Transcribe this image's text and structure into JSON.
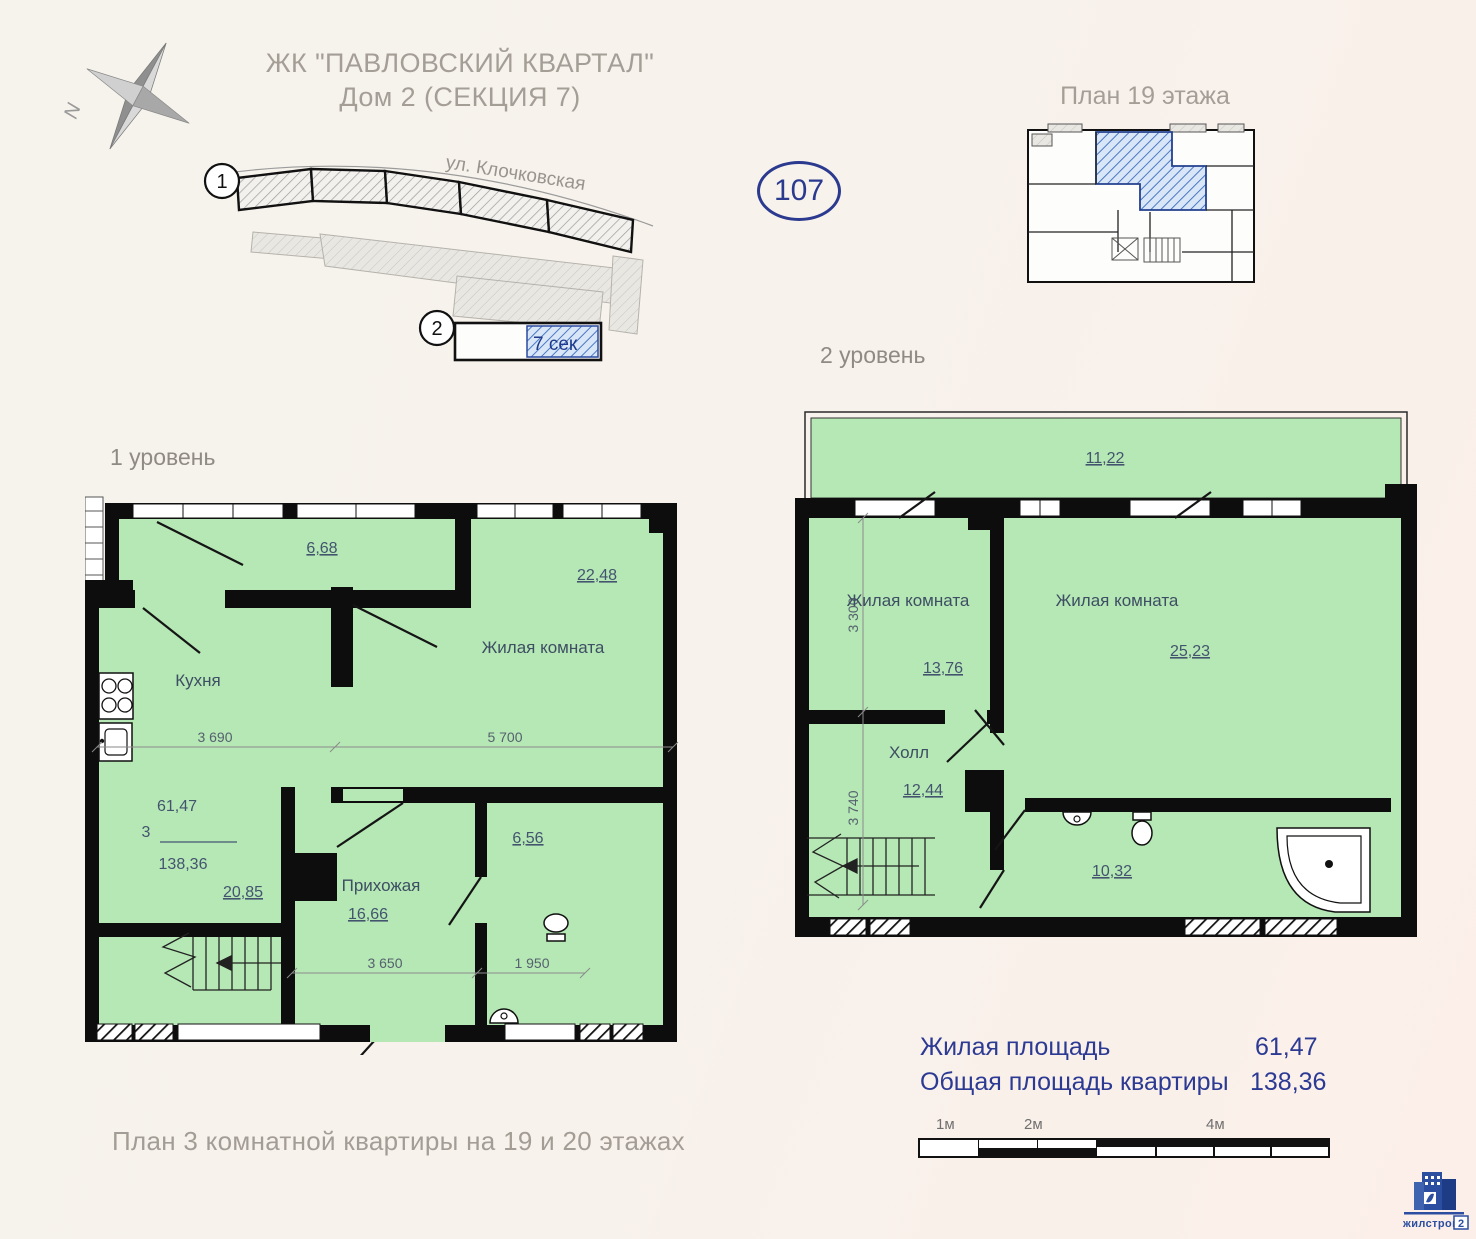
{
  "header": {
    "title_line1": "ЖК \"ПАВЛОВСКИЙ КВАРТАЛ\"",
    "title_line2": "Дом 2 (СЕКЦИЯ 7)",
    "apartment_number": "107",
    "floor_plan_title": "План 19 этажа",
    "compass_north": "N"
  },
  "site": {
    "street": "ул. Клочковская",
    "marker1": "1",
    "marker2": "2",
    "section": "7 сек"
  },
  "level1": {
    "title": "1 уровень",
    "balcony_area": "6,68",
    "living_name": "Жилая комната",
    "living_area": "22,48",
    "kitchen_name": "Кухня",
    "kitchen_living_area": "20,85",
    "rooms_count": "3",
    "living_total": "61,47",
    "total_area": "138,36",
    "hall_name": "Прихожая",
    "hall_area": "16,66",
    "bath_area": "6,56",
    "dim_kitchen": "3 690",
    "dim_living": "5 700",
    "dim_hall": "3 650",
    "dim_bath": "1 950"
  },
  "level2": {
    "title": "2 уровень",
    "terrace_area": "11,22",
    "living1_name": "Жилая комната",
    "living1_area": "13,76",
    "living2_name": "Жилая комната",
    "living2_area": "25,23",
    "hall_name": "Холл",
    "hall_area": "12,44",
    "bath_area": "10,32",
    "dim_v1": "3 300",
    "dim_v2": "3 740"
  },
  "caption": "План 3 комнатной квартиры на 19 и 20 этажах",
  "legend": {
    "living_label": "Жилая площадь",
    "living_value": "61,47",
    "total_label": "Общая площадь квартиры",
    "total_value": "138,36"
  },
  "scalebar": {
    "m1": "1м",
    "m2": "2м",
    "m4": "4м"
  },
  "logo": {
    "name": "жилстрой",
    "number": "2"
  },
  "colors": {
    "plan_fill": "#b5e8b5",
    "accent_blue": "#2c3a94",
    "wall": "#0d0d0d",
    "highlight_hatch": "#4a78c4"
  }
}
